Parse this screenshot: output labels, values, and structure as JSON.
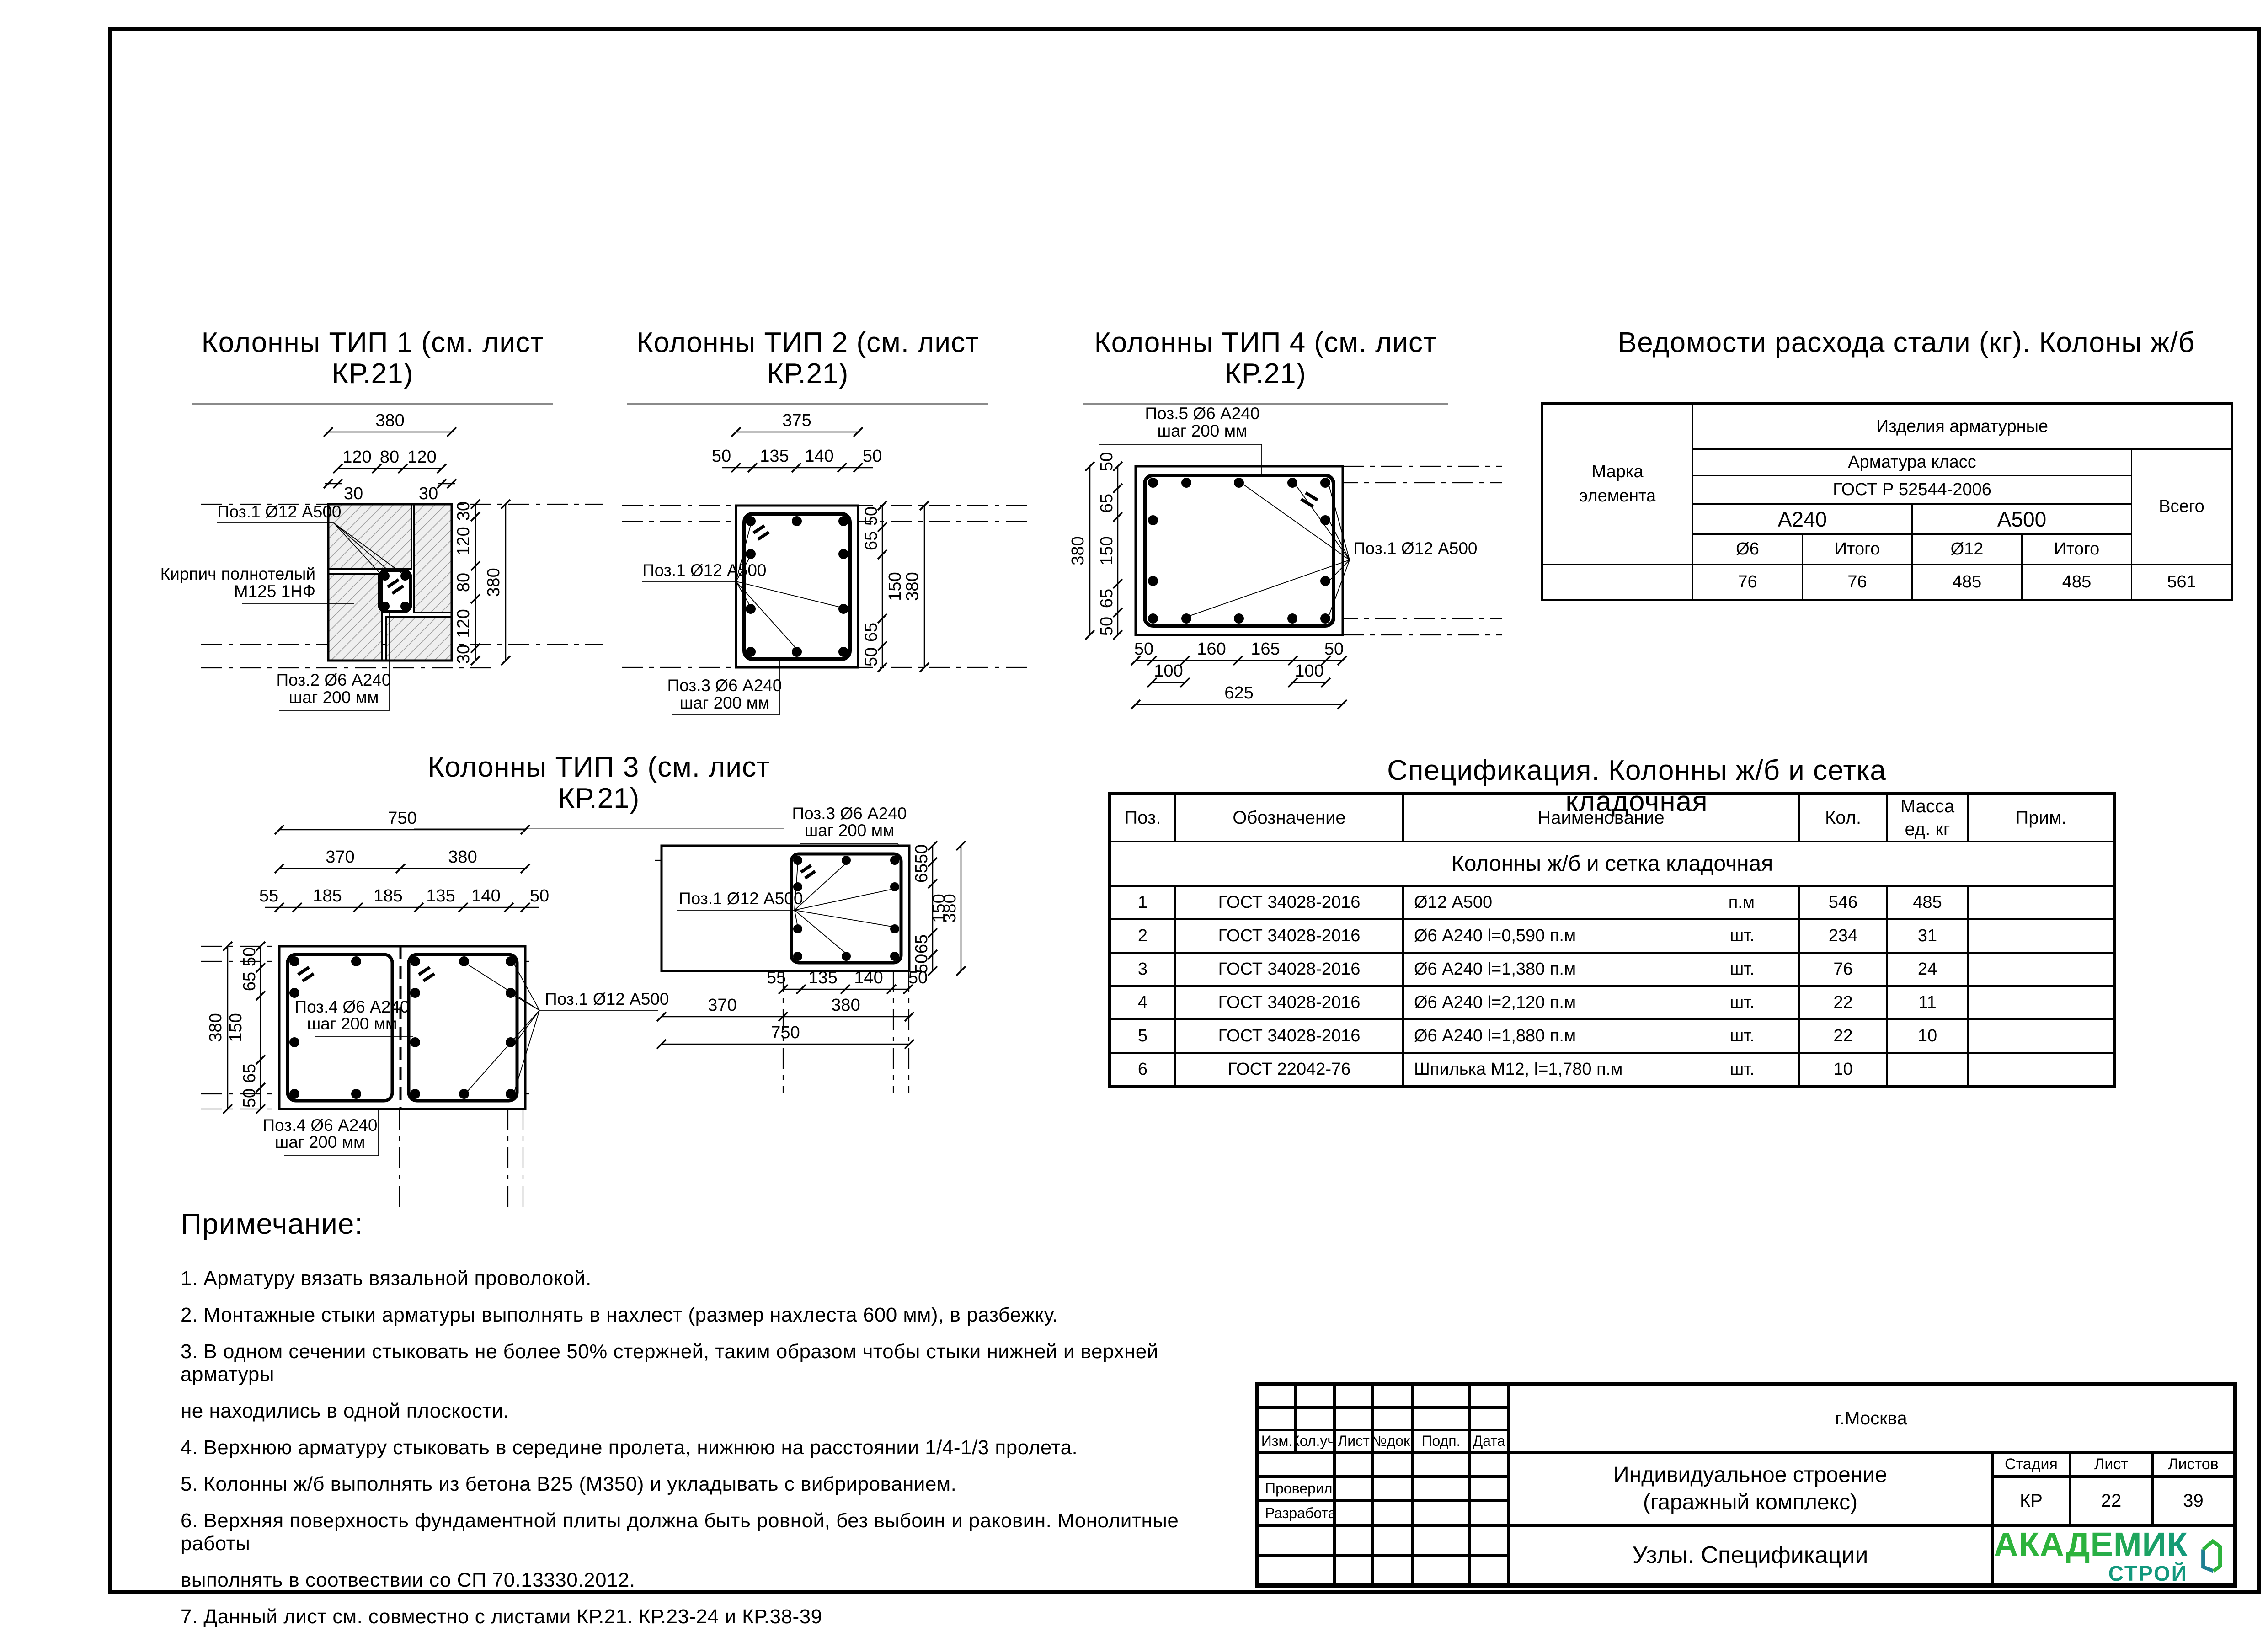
{
  "titles": {
    "tip1": "Колонны ТИП 1 (см. лист КР.21)",
    "tip2": "Колонны ТИП 2 (см. лист КР.21)",
    "tip3": "Колонны ТИП 3 (см. лист КР.21)",
    "tip4": "Колонны ТИП 4 (см. лист КР.21)",
    "steel": "Ведомости расхода стали (кг). Колоны ж/б",
    "spec": "Спецификация. Колонны ж/б и сетка кладочная"
  },
  "tip1": {
    "dims": {
      "w": "380",
      "s1": "120",
      "s2": "80",
      "s3": "120",
      "m1": "30",
      "m2": "30",
      "r1": "30",
      "r2": "120",
      "r3": "80",
      "r4": "120",
      "r5": "30",
      "h": "380"
    },
    "labels": {
      "poz1": "Поз.1 Ø12 А500",
      "brick1": "Кирпич полнотелый",
      "brick2": "М125 1НФ",
      "poz2a": "Поз.2 Ø6 А240",
      "poz2b": "шаг 200 мм"
    }
  },
  "tip2": {
    "dims": {
      "w": "375",
      "s1": "50",
      "s2": "135",
      "s3": "140",
      "s4": "50",
      "r1": "50",
      "r2": "65",
      "r3": "150",
      "r4": "65",
      "r5": "50",
      "h": "380"
    },
    "labels": {
      "poz1": "Поз.1 Ø12 А500",
      "poz3a": "Поз.3 Ø6 А240",
      "poz3b": "шаг 200 мм"
    }
  },
  "tip4": {
    "dims": {
      "l1": "50",
      "l2": "65",
      "l3": "150",
      "l4": "65",
      "l5": "50",
      "h": "380",
      "b1": "50",
      "b2": "160",
      "b3": "165",
      "b4": "50",
      "c1": "100",
      "c2": "100",
      "w": "625"
    },
    "labels": {
      "poz5a": "Поз.5 Ø6 А240",
      "poz5b": "шаг 200 мм",
      "poz1": "Поз.1 Ø12 А500"
    }
  },
  "tip3L": {
    "dims": {
      "w": "750",
      "wa": "370",
      "wb": "380",
      "s1": "55",
      "s2": "185",
      "s3": "185",
      "s4": "135",
      "s5": "140",
      "s6": "50",
      "l1": "50",
      "l2": "65",
      "l3": "150",
      "l4": "65",
      "l5": "50",
      "h": "380"
    },
    "labels": {
      "poz4a": "Поз.4 Ø6 А240",
      "poz4b": "шаг 200 мм",
      "poz4c": "Поз.4 Ø6 А240",
      "poz4d": "шаг 200 мм",
      "poz1": "Поз.1 Ø12 А500"
    }
  },
  "tip3R": {
    "dims": {
      "r1": "50",
      "r2": "65",
      "r3": "150",
      "r4": "65",
      "r5": "50",
      "h": "380",
      "b1": "55",
      "b2": "135",
      "b3": "140",
      "b4": "50",
      "ba": "370",
      "bb": "380",
      "w": "750"
    },
    "labels": {
      "poz3a": "Поз.3 Ø6 А240",
      "poz3b": "шаг 200 мм",
      "poz1": "Поз.1 Ø12 А500"
    }
  },
  "steel": {
    "marka": "Марка элемента",
    "izdeliya": "Изделия арматурные",
    "klass": "Арматура класс",
    "gost": "ГОСТ Р 52544-2006",
    "a240": "А240",
    "a500": "А500",
    "d6": "Ø6",
    "it1": "Итого",
    "d12": "Ø12",
    "it2": "Итого",
    "vsego": "Всего",
    "v1": "76",
    "v2": "76",
    "v3": "485",
    "v4": "485",
    "v5": "561"
  },
  "spec": {
    "h_poz": "Поз.",
    "h_oboz": "Обозначение",
    "h_name": "Наименование",
    "h_kol": "Кол.",
    "h_mass": "Масса ед. кг",
    "h_prim": "Прим.",
    "group": "Колонны ж/б и сетка кладочная",
    "rows": [
      {
        "poz": "1",
        "oboz": "ГОСТ 34028-2016",
        "name": "Ø12 А500",
        "unit": "п.м",
        "kol": "546",
        "mass": "485",
        "prim": ""
      },
      {
        "poz": "2",
        "oboz": "ГОСТ 34028-2016",
        "name": "Ø6 А240 l=0,590 п.м",
        "unit": "шт.",
        "kol": "234",
        "mass": "31",
        "prim": ""
      },
      {
        "poz": "3",
        "oboz": "ГОСТ 34028-2016",
        "name": "Ø6 А240 l=1,380 п.м",
        "unit": "шт.",
        "kol": "76",
        "mass": "24",
        "prim": ""
      },
      {
        "poz": "4",
        "oboz": "ГОСТ 34028-2016",
        "name": "Ø6 А240 l=2,120 п.м",
        "unit": "шт.",
        "kol": "22",
        "mass": "11",
        "prim": ""
      },
      {
        "poz": "5",
        "oboz": "ГОСТ 34028-2016",
        "name": "Ø6 А240 l=1,880 п.м",
        "unit": "шт.",
        "kol": "22",
        "mass": "10",
        "prim": ""
      },
      {
        "poz": "6",
        "oboz": "ГОСТ 22042-76",
        "name": "Шпилька М12, l=1,780 п.м",
        "unit": "шт.",
        "kol": "10",
        "mass": "",
        "prim": ""
      }
    ]
  },
  "notes": {
    "heading": "Примечание:",
    "lines": [
      "1. Арматуру вязать вязальной проволокой.",
      "2. Монтажные стыки арматуры выполнять в нахлест (размер нахлеста 600 мм), в разбежку.",
      "3. В одном сечении стыковать не более 50% стержней, таким образом чтобы стыки нижней и верхней арматуры",
      "не находились в одной плоскости.",
      "4. Верхнюю арматуру стыковать в середине пролета, нижнюю на расстоянии 1/4-1/3 пролета.",
      "5. Колонны ж/б выполнять из бетона В25 (М350) и укладывать с вибрированием.",
      "6. Верхняя поверхность фундаментной плиты должна быть ровной, без выбоин и раковин. Монолитные работы",
      "выполнять в соотвествии со СП 70.13330.2012.",
      "7. Данный лист см. совместно с листами КР.21. КР.23-24 и КР.38-39"
    ]
  },
  "tb": {
    "city": "г.Москва",
    "c1": "Изм.",
    "c2": "Кол.уч.",
    "c3": "Лист",
    "c4": "№док.",
    "c5": "Подп.",
    "c6": "Дата",
    "proveril": "Проверил",
    "razrabotal": "Разработал",
    "p1": "Индивидуальное строение",
    "p2": "(гаражный комплекс)",
    "stadia": "Стадия",
    "list": "Лист",
    "listov": "Листов",
    "stadia_v": "КР",
    "list_v": "22",
    "listov_v": "39",
    "doc": "Узлы. Спецификации"
  },
  "logo": {
    "top": "АКАДЕМИК",
    "bottom": "СТРОЙ",
    "green": "#2db33c",
    "teal": "#12987d",
    "house_teal": "#1d7f92"
  }
}
